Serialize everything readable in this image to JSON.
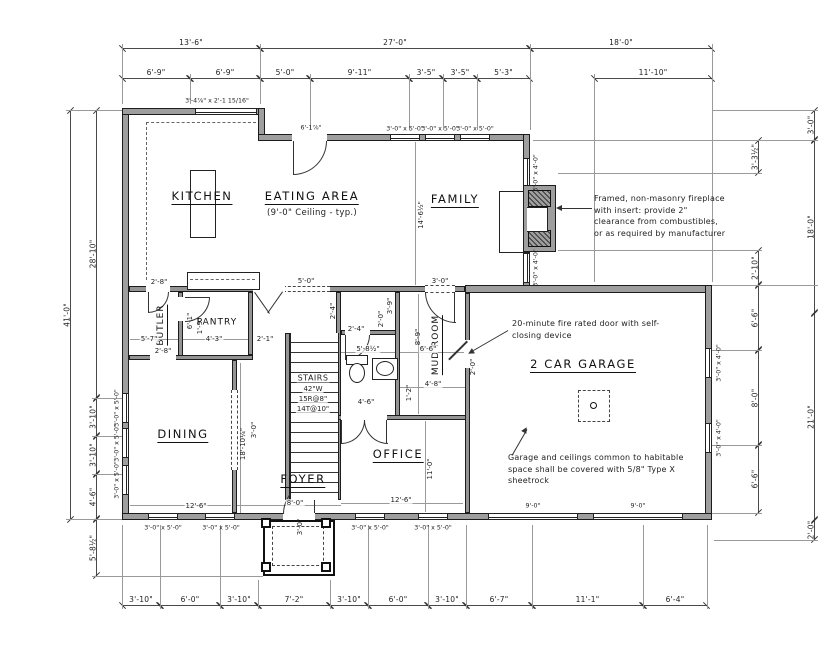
{
  "drawing_type": "first floor plan",
  "colors": {
    "wall_fill": "#9e9e9e",
    "line": "#1c1c1c",
    "background": "#ffffff"
  },
  "rooms": {
    "kitchen": {
      "label": "KITCHEN"
    },
    "eating": {
      "label": "EATING AREA",
      "ceiling": "(9'-0\" Ceiling - typ.)"
    },
    "family": {
      "label": "FAMILY"
    },
    "dining": {
      "label": "DINING"
    },
    "foyer": {
      "label": "FOYER"
    },
    "office": {
      "label": "OFFICE"
    },
    "garage": {
      "label": "2 CAR GARAGE"
    },
    "pantry": {
      "label": "PANTRY"
    },
    "butler": {
      "label": "BUTLER"
    },
    "mudroom": {
      "label": "MUD ROOM"
    },
    "stairs": {
      "line1": "STAIRS",
      "line2": "42\"W",
      "line3": "15R@8\"",
      "line4": "14T@10\""
    }
  },
  "notes": {
    "fireplace": "Framed, non-masonry fireplace with insert: provide 2\" clearance from combustibles, or as required by manufacturer",
    "fire_door": "20-minute fire rated door with self-closing device",
    "garage_wall": "Garage and ceilings common to habitable space shall be covered with 5/8\" Type X sheetrock"
  },
  "dims": {
    "top_outer": [
      "13'-6\"",
      "27'-0\"",
      "18'-0\""
    ],
    "top_inner": [
      "6'-9\"",
      "6'-9\"",
      "5'-0\"",
      "9'-11\"",
      "3'-5\"",
      "3'-5\"",
      "5'-3\"",
      "11'-10\""
    ],
    "left_outer": [
      "41'-0\""
    ],
    "left_inner": [
      "28'-10\"",
      "3'-10\"",
      "3'-10\"",
      "4'-6\"",
      "5'-8½\""
    ],
    "right_outer": [
      "3'-0\"",
      "18'-0\"",
      "21'-0\"",
      "2'-0\""
    ],
    "right_inner": [
      "3'-3½\"",
      "2'-10\"",
      "6'-6\"",
      "8'-0\"",
      "6'-6\""
    ],
    "bottom": [
      "3'-10\"",
      "6'-0\"",
      "3'-10\"",
      "7'-2\"",
      "3'-10\"",
      "6'-0\"",
      "3'-10\"",
      "6'-7\"",
      "11'-1\"",
      "6'-4\""
    ]
  },
  "openings": {
    "kitchen_window": "3'-4⅞\" x 2'-1 15/16\"",
    "eating_door": "6'-1⅞\"",
    "family_windows": [
      "3'-0\" x 5'-0\"",
      "3'-0\" x 5'-0\"",
      "3'-0\" x 5'-0\""
    ],
    "family_side_windows": [
      "3'-0\" x 4'-0\"",
      "3'-0\" x 4'-0\""
    ],
    "garage_side_windows": [
      "3'-0\" x 4'-0\"",
      "3'-0\" x 4'-0\""
    ],
    "left_windows": [
      "3'-0\" x 5'-0\"",
      "3'-0\" x 5'-0\"",
      "3'-0\" x 5'-0\""
    ],
    "bottom_windows": [
      "3'-0\" x 5'-0\"",
      "3'-0\" x 5'-0\"",
      "3'-0\" x 5'-0\"",
      "3'-0\" x 5'-0\""
    ],
    "garage_doors": [
      "9'-0\"",
      "9'-0\""
    ]
  },
  "interior_dims": [
    "14'-6½\"",
    "2'-8\"",
    "6'-1\"",
    "5'-7\"",
    "4'-3\"",
    "2'-1\"",
    "1'-9\"",
    "2'-8\"",
    "5'-0\"",
    "3'-0\"",
    "2'-4\"",
    "3'-9\"",
    "2'-0\"",
    "5'-8½\"",
    "6'-6\"",
    "8'-9\"",
    "2'-4\"",
    "4'-8\"",
    "1'-2\"",
    "2'-0\"",
    "4'-6\"",
    "18'-10¼\"",
    "3'-0\"",
    "12'-6\"",
    "8'-0\"",
    "3'-0\"",
    "12'-6\"",
    "11'-0\""
  ]
}
